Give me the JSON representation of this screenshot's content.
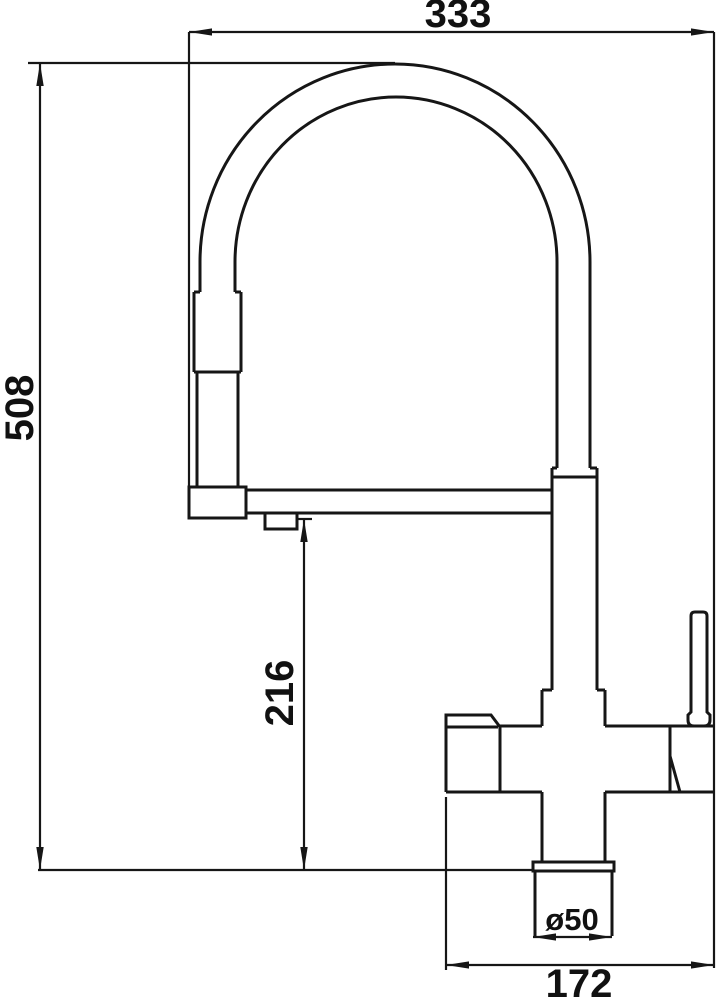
{
  "drawing": {
    "background_color": "#ffffff",
    "line_color": "#161616",
    "dimensions": {
      "overall_width": "333",
      "overall_height": "508",
      "outlet_height": "216",
      "base_diameter": "ø50",
      "base_span": "172"
    }
  }
}
